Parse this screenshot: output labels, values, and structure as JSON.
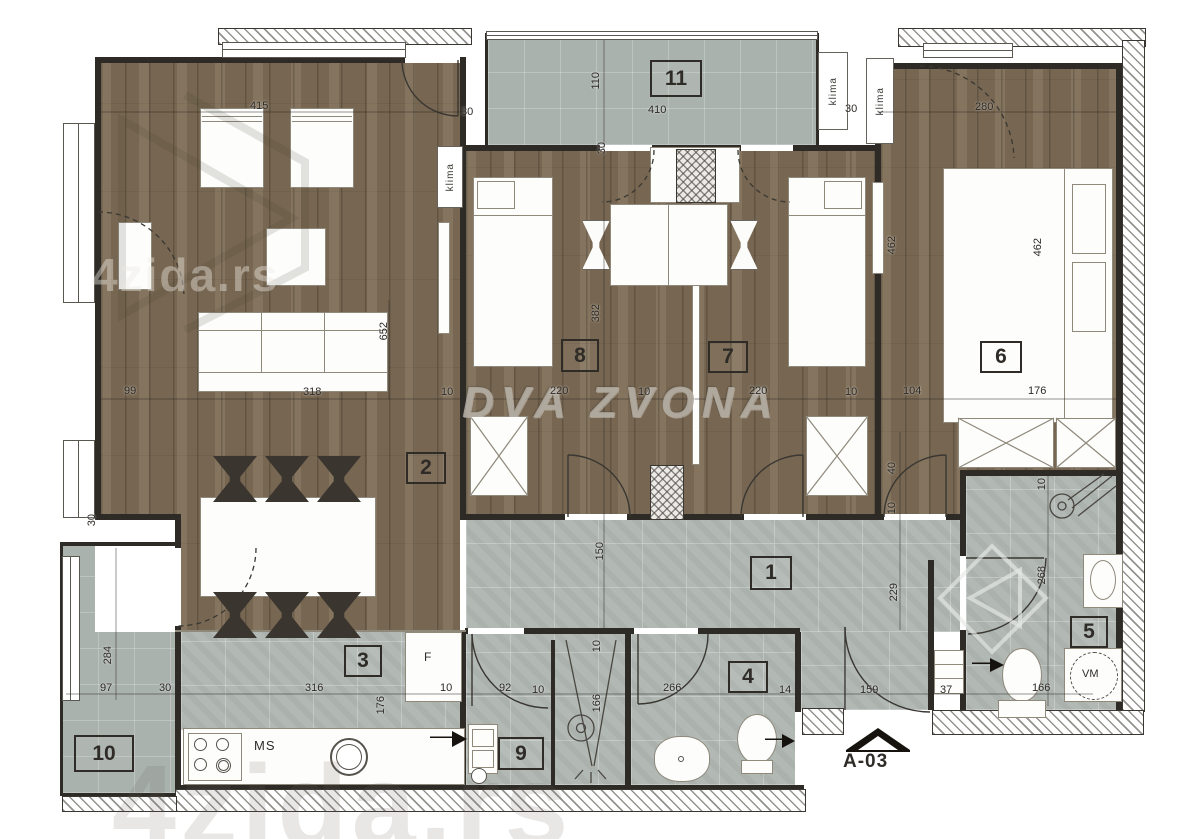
{
  "rooms": {
    "r1": "1",
    "r2": "2",
    "r3": "3",
    "r4": "4",
    "r5": "5",
    "r6": "6",
    "r7": "7",
    "r8": "8",
    "r9": "9",
    "r10": "10",
    "r11": "11"
  },
  "dims": {
    "d10": "10",
    "d14": "14",
    "d30": "30",
    "d37": "37",
    "d40": "40",
    "d92": "92",
    "d97": "97",
    "d99": "99",
    "d104": "104",
    "d110": "110",
    "d150": "150",
    "d159": "159",
    "d166": "166",
    "d176": "176",
    "d220": "220",
    "d229": "229",
    "d266": "266",
    "d268": "268",
    "d280": "280",
    "d284": "284",
    "d316": "316",
    "d318": "318",
    "d382": "382",
    "d410": "410",
    "d415": "415",
    "d462": "462",
    "d652": "652"
  },
  "labels": {
    "klima": "klima",
    "kitchen_counter": "MS",
    "fridge": "F",
    "washing_machine": "VM",
    "plan_marker": "A-03"
  },
  "watermarks": {
    "agency": "DVA ZVONA",
    "brand": "4zida.rs"
  },
  "colors": {
    "wood": "#7d6c55",
    "tile": "#b2b9b5",
    "wall": "#2e2b27",
    "watermark_gray": "#b2aba0"
  }
}
